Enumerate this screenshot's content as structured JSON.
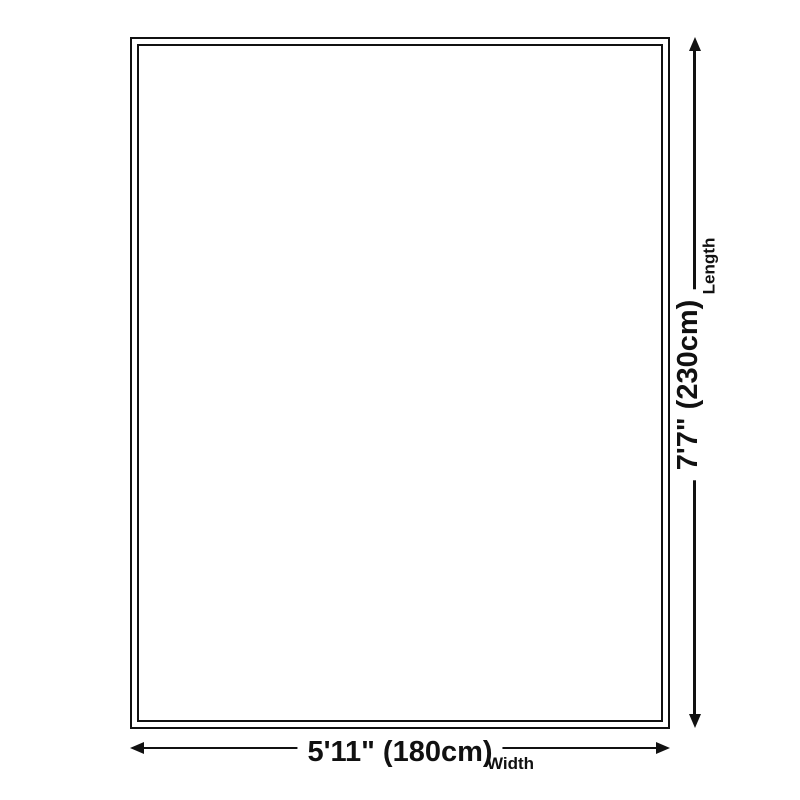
{
  "diagram": {
    "type": "product-dimension-diagram",
    "background_color": "#ffffff",
    "line_color": "#111111",
    "length": {
      "value": "7'7\" (230cm)",
      "label": "Length"
    },
    "width": {
      "value": "5'11\" (180cm)",
      "label": "Width"
    }
  }
}
